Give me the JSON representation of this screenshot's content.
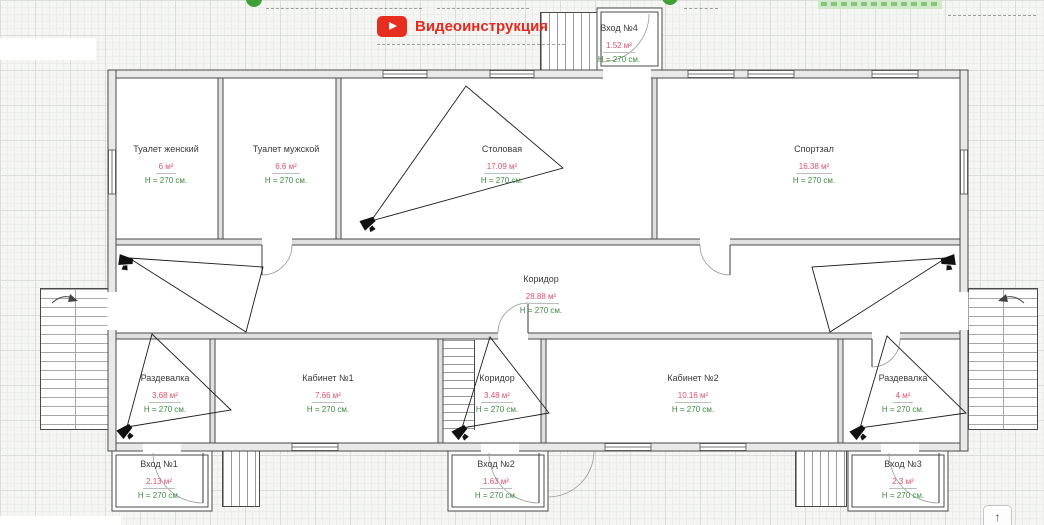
{
  "header": {
    "video_instruction": {
      "label": "Видеоинструкция",
      "icon": "youtube-play"
    }
  },
  "plan": {
    "rooms": [
      {
        "name": "Туалет женский",
        "area": "6 м²",
        "height": "H = 270 см."
      },
      {
        "name": "Туалет мужской",
        "area": "6.6 м²",
        "height": "H = 270 см."
      },
      {
        "name": "Столовая",
        "area": "17.09 м²",
        "height": "H = 270 см."
      },
      {
        "name": "Спортзал",
        "area": "16.38 м²",
        "height": "H = 270 см."
      },
      {
        "name": "Коридор",
        "area": "28.88 м²",
        "height": "H = 270 см."
      },
      {
        "name": "Раздевалка",
        "area": "3.68 м²",
        "height": "H = 270 см."
      },
      {
        "name": "Кабинет №1",
        "area": "7.66 м²",
        "height": "H = 270 см."
      },
      {
        "name": "Коридор",
        "area": "3.48 м²",
        "height": "H = 270 см."
      },
      {
        "name": "Кабинет №2",
        "area": "10.16 м²",
        "height": "H = 270 см."
      },
      {
        "name": "Раздевалка",
        "area": "4 м²",
        "height": "H = 270 см."
      },
      {
        "name": "Вход №1",
        "area": "2.13 м²",
        "height": "H = 270 см."
      },
      {
        "name": "Вход №2",
        "area": "1.63 м²",
        "height": "H = 270 см."
      },
      {
        "name": "Вход №3",
        "area": "2.3 м²",
        "height": "H = 270 см."
      },
      {
        "name": "Вход №4",
        "area": "1.52 м²",
        "height": "H = 270 см."
      }
    ],
    "cameras": {
      "icon": "cctv-camera",
      "count": 6
    }
  },
  "controls": {
    "scroll_top_icon": "↑"
  },
  "colors": {
    "accent_red": "#e3281e",
    "youtube_red": "#e62d20",
    "area_text": "#e0506e",
    "height_text": "#3d8b40"
  }
}
